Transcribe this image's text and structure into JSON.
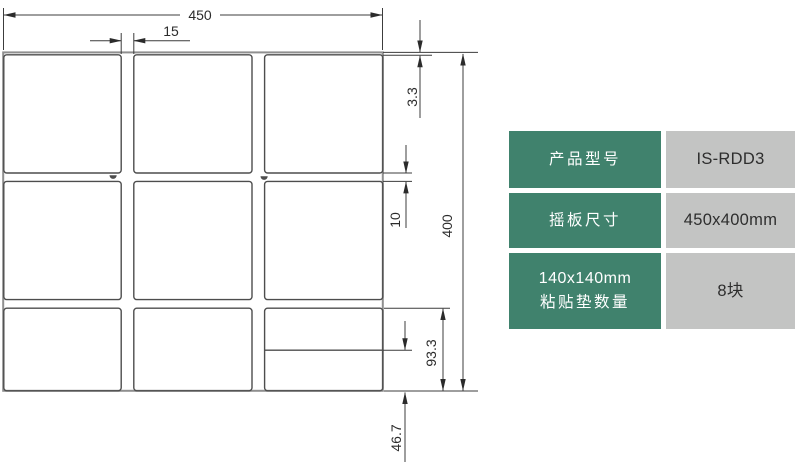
{
  "drawing": {
    "dim_width_total": "450",
    "dim_pad_gap_horizontal": "15",
    "dim_top_margin": "3.3",
    "dim_row_gap": "10",
    "dim_height_total": "400",
    "dim_bottom_pad_visible": "93.3",
    "dim_bottom_pad_cut": "46.7"
  },
  "table": {
    "colors": {
      "label_bg": "#40826D",
      "value_bg": "#C3C4C3"
    },
    "rows": [
      {
        "label": "产品型号",
        "value": "IS-RDD3"
      },
      {
        "label": "摇板尺寸",
        "value": "450x400mm"
      },
      {
        "label_line1": "140x140mm",
        "label_line2": "粘贴垫数量",
        "value": "8块"
      }
    ]
  }
}
